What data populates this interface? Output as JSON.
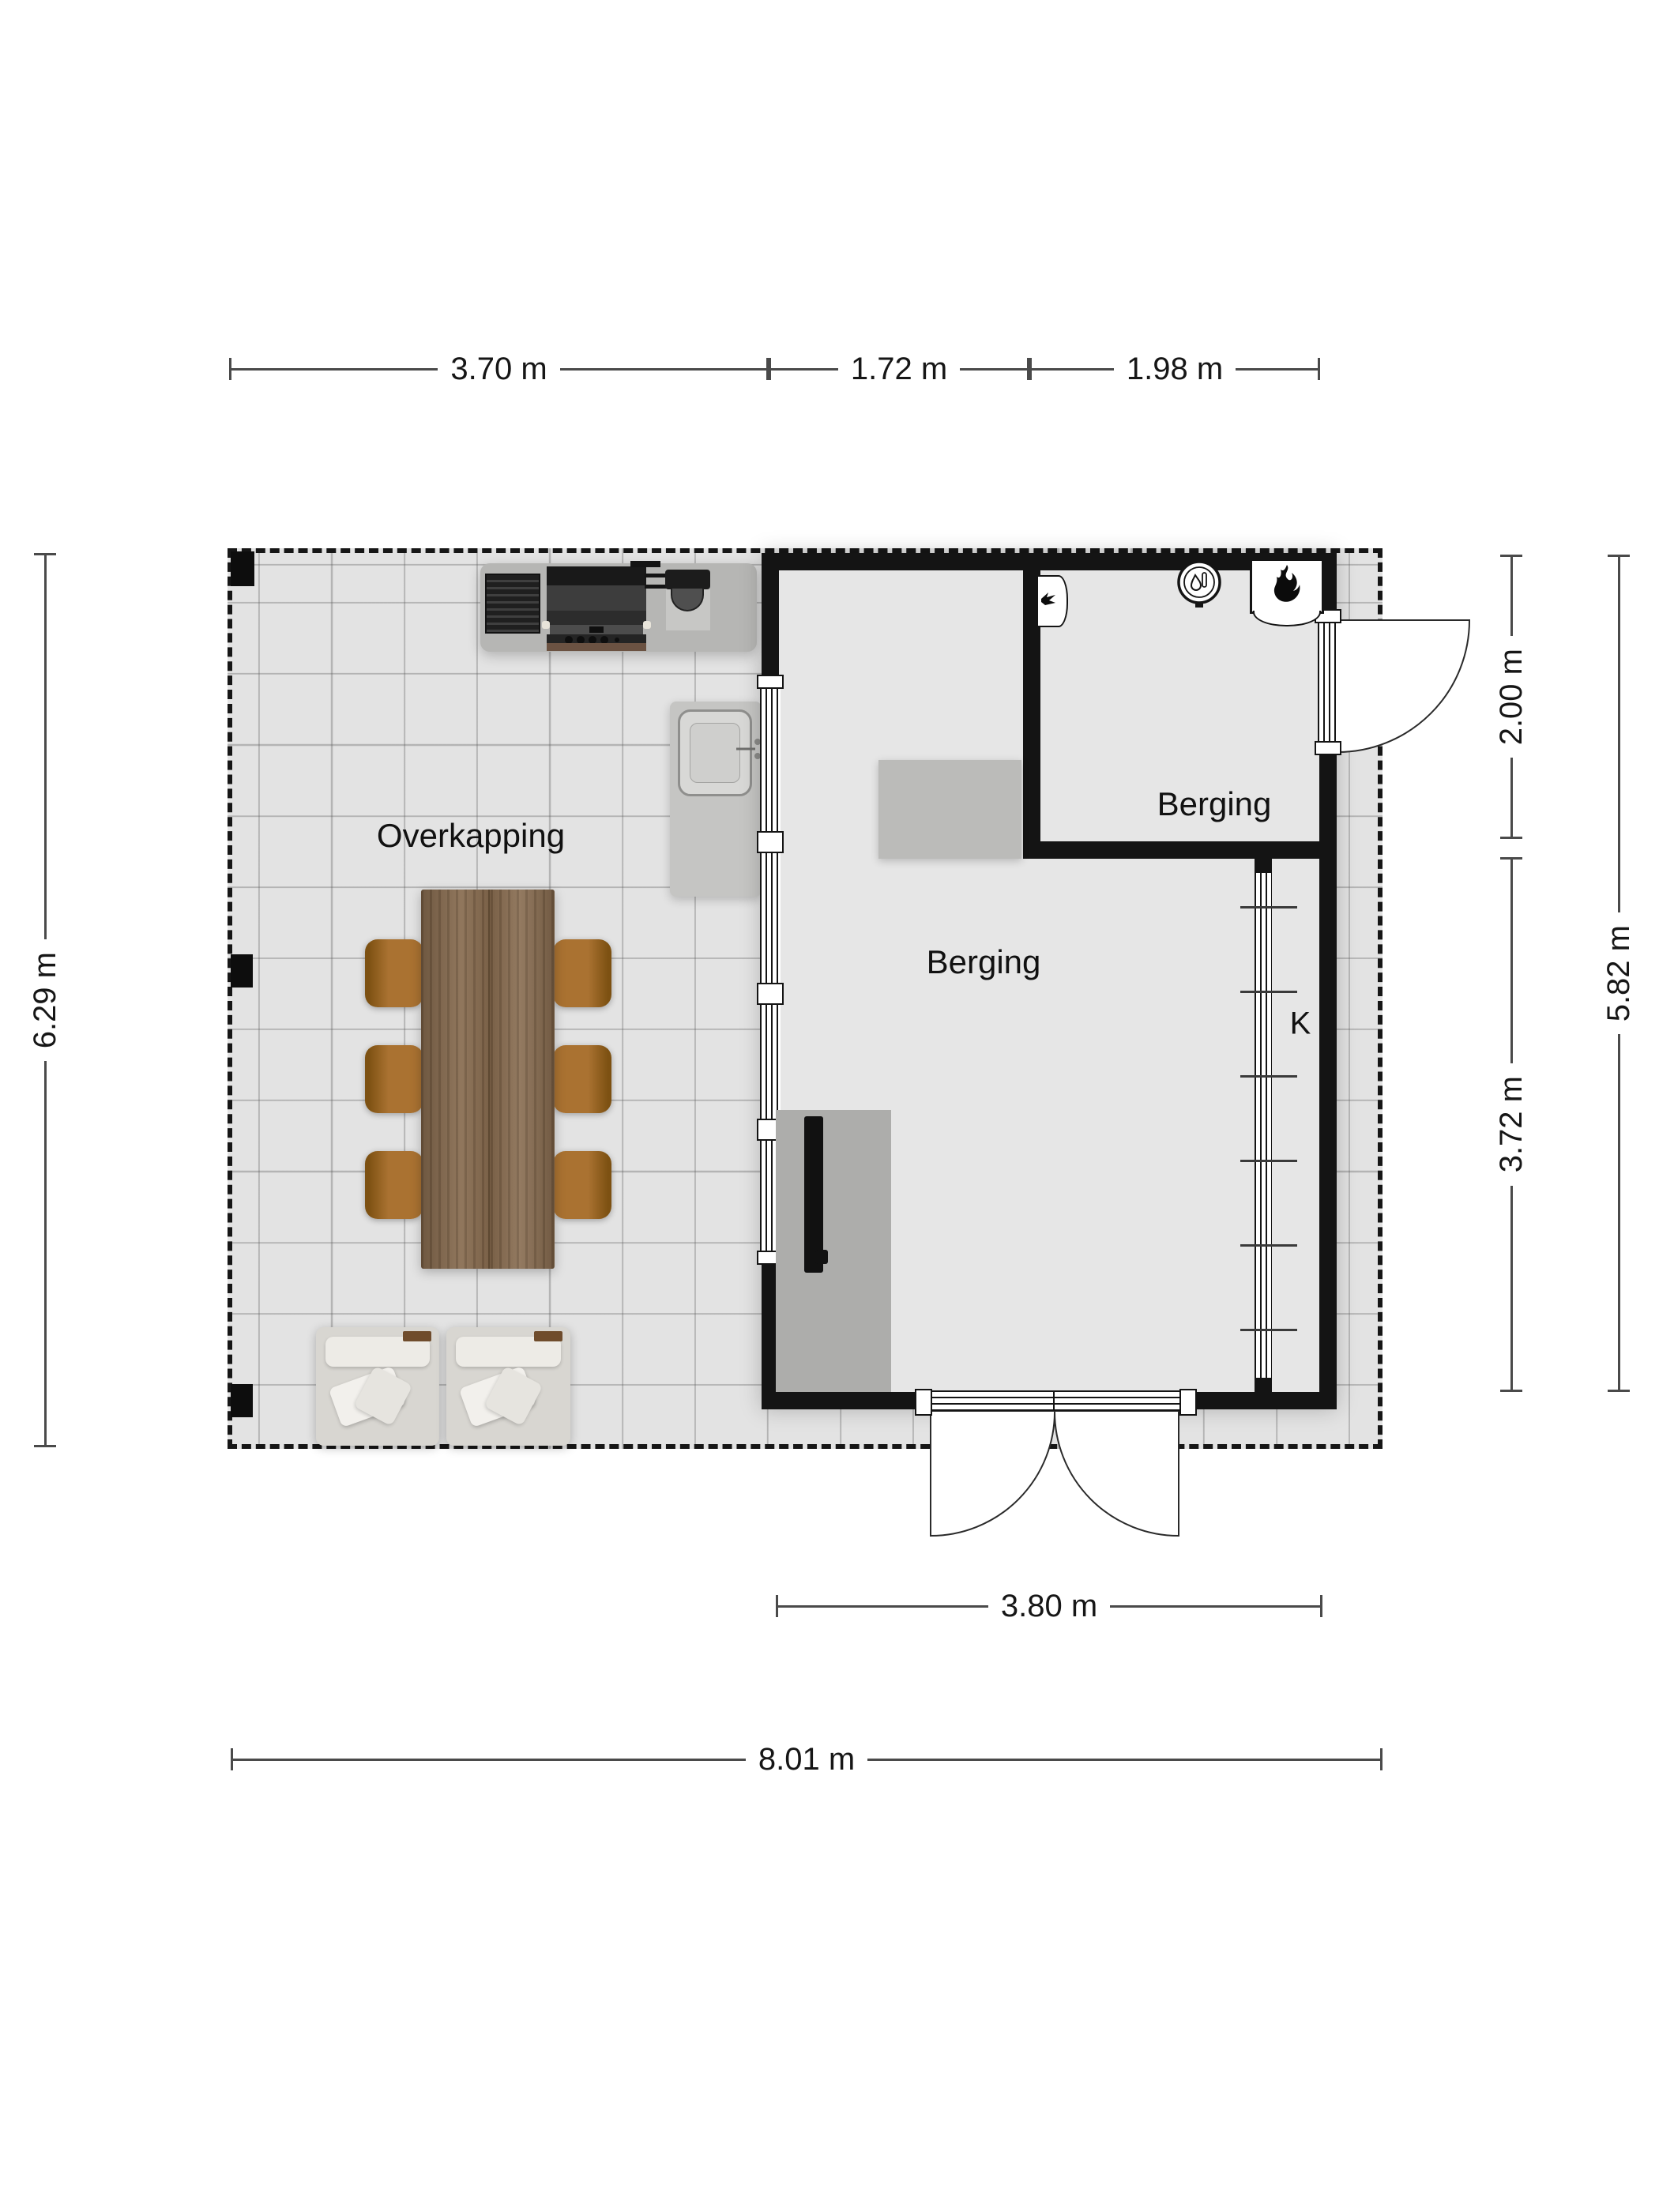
{
  "plan": {
    "title": "Floor plan — Overkapping / Berging",
    "rooms": {
      "overkapping": {
        "label": "Overkapping"
      },
      "berging_small": {
        "label": "Berging"
      },
      "berging_main": {
        "label": "Berging"
      },
      "closet": {
        "label": "K"
      }
    },
    "dimensions": {
      "top": [
        "3.70 m",
        "1.72 m",
        "1.98 m"
      ],
      "left": "6.29 m",
      "right_inner_top": "2.00 m",
      "right_inner_bottom": "3.72 m",
      "right_outer": "5.82 m",
      "bottom_inner": "3.80 m",
      "bottom_outer": "8.01 m"
    },
    "icons": [
      "bbq-grill-icon",
      "kamado-grill-icon",
      "outdoor-sink-icon",
      "faucet-icon",
      "dining-table",
      "dining-chair",
      "armchair",
      "support-post",
      "meter-box-icon",
      "boiler-icon",
      "cv-ketel-flame-icon",
      "stove-icon",
      "closet-rack-icon",
      "window",
      "door-swing",
      "double-door"
    ],
    "colors": {
      "wall": "#141414",
      "outdoor_floor": "#e3e3e3",
      "indoor_floor": "#e6e6e6",
      "grid_line": "#9a9a9a",
      "wood": "#876b4f",
      "chair_brown": "#aa7231",
      "counter_gray": "#b6b6b4",
      "dimension_line": "#4a4a4a"
    }
  }
}
